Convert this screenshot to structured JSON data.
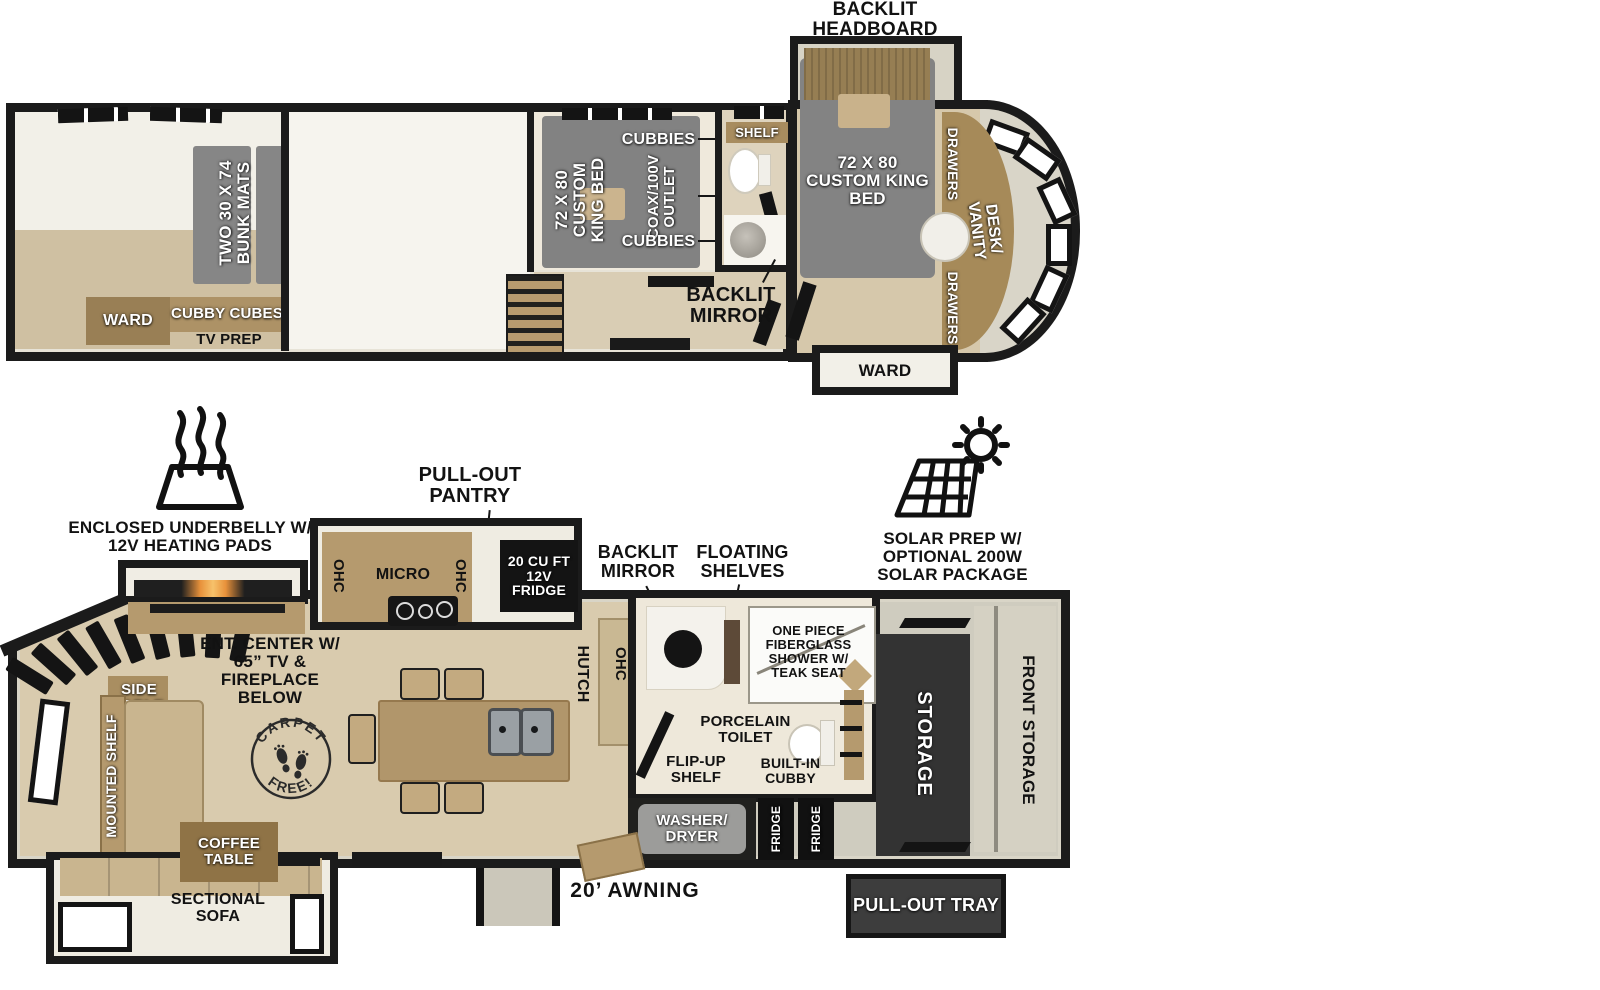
{
  "upper_deck": {
    "backlit_headboard": "BACKLIT HEADBOARD",
    "bunk_mats": "TWO 30 X 74 BUNK MATS",
    "ward": "WARD",
    "cubby_cubes": "CUBBY CUBES",
    "tv_prep": "TV PREP",
    "king_bed_mid": "72 X 80 CUSTOM KING BED",
    "cubbies_top": "CUBBIES",
    "coax_outlet": "COAX/100V OUTLET",
    "cubbies_bottom": "CUBBIES",
    "shelf": "SHELF",
    "backlit_mirror": "BACKLIT MIRROR",
    "king_bed_front": "72 X 80 CUSTOM KING BED",
    "drawers_upper": "DRAWERS",
    "desk_vanity": "DESK/ VANITY",
    "drawers_lower": "DRAWERS",
    "ward_front": "WARD"
  },
  "main_deck": {
    "underbelly": "ENCLOSED UNDERBELLY W/ 12V HEATING PADS",
    "pull_out_pantry": "PULL-OUT PANTRY",
    "solar_prep": "SOLAR PREP W/ OPTIONAL 200W SOLAR PACKAGE",
    "ohc_left": "OHC",
    "micro": "MICRO",
    "ohc_right": "OHC",
    "fridge_20": "20 CU FT 12V FRIDGE",
    "backlit_mirror": "BACKLIT MIRROR",
    "floating_shelves": "FLOATING SHELVES",
    "ent_center": "ENT. CENTER W/ 65” TV & FIREPLACE BELOW",
    "side_table": "SIDE TABLE",
    "mounted_shelf": "MOUNTED SHELF",
    "ohc_hutch_ohc": "OHC",
    "hutch": "HUTCH",
    "shower": "ONE PIECE FIBERGLASS SHOWER W/ TEAK SEAT",
    "porcelain_toilet": "PORCELAIN TOILET",
    "flip_up_shelf": "FLIP-UP SHELF",
    "built_in_cubby": "BUILT-IN CUBBY",
    "washer_dryer": "WASHER/ DRYER",
    "fridge_1": "FRIDGE",
    "fridge_2": "FRIDGE",
    "storage": "STORAGE",
    "front_storage": "FRONT STORAGE",
    "pull_out_tray": "PULL-OUT TRAY",
    "coffee_table": "COFFEE TABLE",
    "sectional_sofa": "SECTIONAL SOFA",
    "awning": "20’ AWNING"
  },
  "badge": {
    "top": "CARPET",
    "bottom": "FREE!"
  },
  "colors": {
    "wall_dark": "#1b1b1b",
    "wood": "#b59a6e",
    "wood_dark": "#8f7346",
    "bed_gray": "#838383",
    "floor_wood": "#d9cbae",
    "appliance_black": "#141414",
    "storage_dark": "#333333",
    "sofa_tan": "#c9b58f",
    "fireplace_glow": "#f0a44c"
  }
}
